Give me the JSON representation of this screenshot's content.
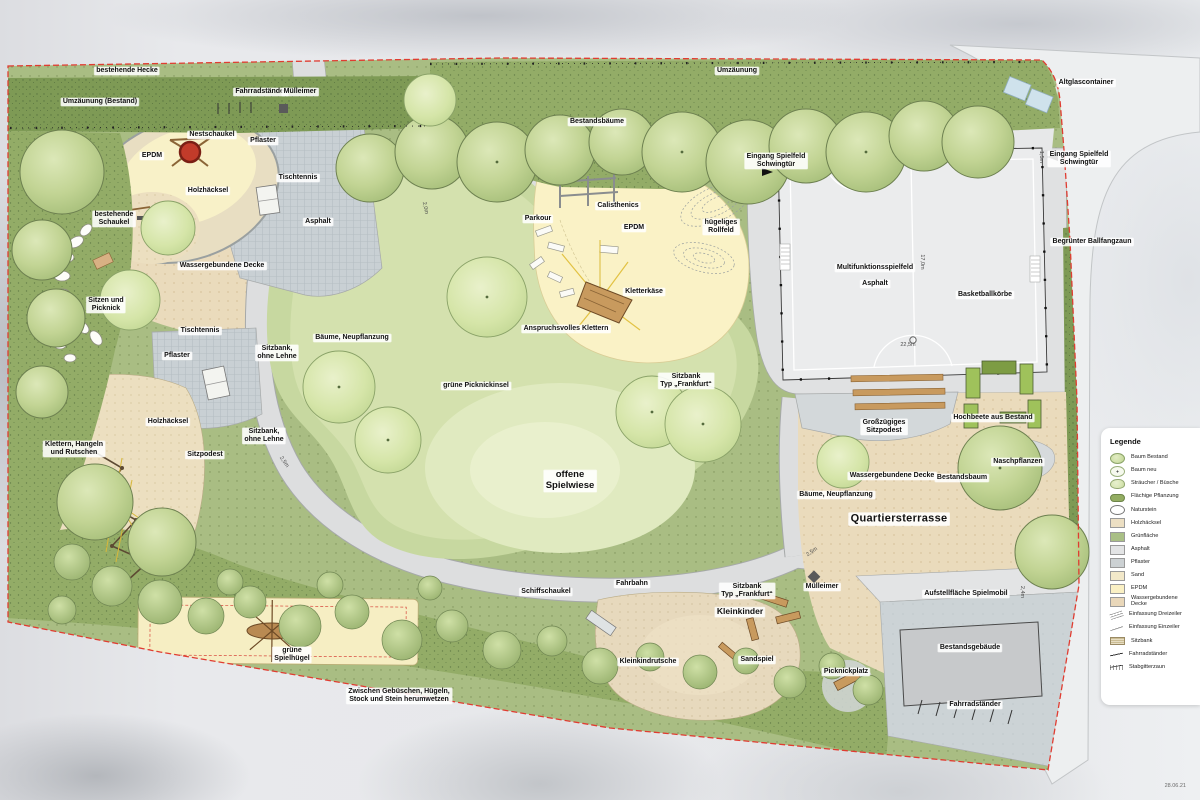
{
  "stamp": {
    "date": "28.06.21"
  },
  "legend": {
    "title": "Legende",
    "items": [
      {
        "label": "Baum Bestand",
        "icon": "tree-existing"
      },
      {
        "label": "Baum neu",
        "icon": "tree-new"
      },
      {
        "label": "Sträucher / Büsche",
        "icon": "shrub"
      },
      {
        "label": "Flächige Pflanzung",
        "icon": "planting"
      },
      {
        "label": "Naturstein",
        "icon": "stone"
      },
      {
        "label": "Holzhäcksel",
        "icon": "swatch",
        "color": "#ecdfc3"
      },
      {
        "label": "Grünfläche",
        "icon": "swatch",
        "color": "#a9bf85"
      },
      {
        "label": "Asphalt",
        "icon": "swatch",
        "color": "#e3e4e5"
      },
      {
        "label": "Pflaster",
        "icon": "swatch",
        "color": "#ccd1d3"
      },
      {
        "label": "Sand",
        "icon": "swatch",
        "color": "#f2e8c9"
      },
      {
        "label": "EPDM",
        "icon": "swatch",
        "color": "#faf0c4"
      },
      {
        "label": "Wassergebundene Decke",
        "icon": "swatch",
        "color": "#e9d7b9"
      },
      {
        "label": "Einfassung Dreizeiler",
        "icon": "edging-three"
      },
      {
        "label": "Einfassung Einzeiler",
        "icon": "edging-one"
      },
      {
        "label": "Sitzbank",
        "icon": "bench"
      },
      {
        "label": "Fahrradständer",
        "icon": "bike-rack"
      },
      {
        "label": "Stabgitterzaun",
        "icon": "fence"
      }
    ]
  },
  "map_labels": [
    {
      "name": "label-bestehende-hecke",
      "text": "bestehende Hecke",
      "x": 127,
      "y": 71
    },
    {
      "name": "label-umzaeunung-bestand",
      "text": "Umzäunung (Bestand)",
      "x": 100,
      "y": 102
    },
    {
      "name": "label-fahrradstaender-top",
      "text": "Fahrradständer",
      "x": 261,
      "y": 92
    },
    {
      "name": "label-muelleimer-top",
      "text": "Mülleimer",
      "x": 300,
      "y": 92
    },
    {
      "name": "label-bestandsbaeume",
      "text": "Bestandsbäume",
      "x": 597,
      "y": 122
    },
    {
      "name": "label-umzaeunung",
      "text": "Umzäunung",
      "x": 737,
      "y": 71
    },
    {
      "name": "label-altglascontainer",
      "text": "Altglascontainer",
      "x": 1086,
      "y": 83
    },
    {
      "name": "label-eingang-spielfeld-1",
      "text": "Eingang Spielfeld\nSchwingtür",
      "x": 776,
      "y": 161
    },
    {
      "name": "label-eingang-spielfeld-2",
      "text": "Eingang Spielfeld\nSchwingtür",
      "x": 1079,
      "y": 159
    },
    {
      "name": "label-nestschaukel",
      "text": "Nestschaukel",
      "x": 212,
      "y": 135
    },
    {
      "name": "label-pflaster-1",
      "text": "Pflaster",
      "x": 263,
      "y": 141
    },
    {
      "name": "label-epdm-1",
      "text": "EPDM",
      "x": 152,
      "y": 156
    },
    {
      "name": "label-tischtennis-1",
      "text": "Tischtennis",
      "x": 298,
      "y": 178
    },
    {
      "name": "label-holzhaecksel-1",
      "text": "Holzhäcksel",
      "x": 208,
      "y": 191
    },
    {
      "name": "label-bestehende-schaukel",
      "text": "bestehende\nSchaukel",
      "x": 114,
      "y": 219
    },
    {
      "name": "label-asphalt-weg",
      "text": "Asphalt",
      "x": 318,
      "y": 222
    },
    {
      "name": "label-wassergebundene-decke-1",
      "text": "Wassergebundene Decke",
      "x": 222,
      "y": 266
    },
    {
      "name": "label-parkour",
      "text": "Parkour",
      "x": 538,
      "y": 219
    },
    {
      "name": "label-calisthenics",
      "text": "Calisthenics",
      "x": 618,
      "y": 206
    },
    {
      "name": "label-epdm-2",
      "text": "EPDM",
      "x": 634,
      "y": 228
    },
    {
      "name": "label-huegeliges-rollfeld",
      "text": "hügeliges\nRollfeld",
      "x": 721,
      "y": 227
    },
    {
      "name": "label-multifunktionsspielfeld",
      "text": "Multifunktionsspielfeld",
      "x": 875,
      "y": 268
    },
    {
      "name": "label-asphalt-feld",
      "text": "Asphalt",
      "x": 875,
      "y": 284
    },
    {
      "name": "label-basketballkoerbe",
      "text": "Basketballkörbe",
      "x": 985,
      "y": 295
    },
    {
      "name": "label-begruenter-ballfangzaun",
      "text": "Begrünter Ballfangzaun",
      "x": 1092,
      "y": 242
    },
    {
      "name": "label-sitzen-und-picknick",
      "text": "Sitzen und\nPicknick",
      "x": 106,
      "y": 305
    },
    {
      "name": "label-tischtennis-2",
      "text": "Tischtennis",
      "x": 200,
      "y": 331
    },
    {
      "name": "label-pflaster-2",
      "text": "Pflaster",
      "x": 177,
      "y": 356
    },
    {
      "name": "label-baeume-neupflanzung-1",
      "text": "Bäume, Neupflanzung",
      "x": 352,
      "y": 338
    },
    {
      "name": "label-sitzbank-ohne-lehne-1",
      "text": "Sitzbank,\nohne Lehne",
      "x": 277,
      "y": 353
    },
    {
      "name": "label-kletterkaese",
      "text": "Kletterkäse",
      "x": 644,
      "y": 292
    },
    {
      "name": "label-anspruchsvolles-klettern",
      "text": "Anspruchsvolles Klettern",
      "x": 566,
      "y": 329
    },
    {
      "name": "label-sitzbank-frankfurt-1",
      "text": "Sitzbank\nTyp „Frankfurt“",
      "x": 686,
      "y": 381
    },
    {
      "name": "label-gruene-picknickinsel",
      "text": "grüne Picknickinsel",
      "x": 476,
      "y": 386
    },
    {
      "name": "label-holzhaecksel-2",
      "text": "Holzhäcksel",
      "x": 168,
      "y": 422
    },
    {
      "name": "label-sitzbank-ohne-lehne-2",
      "text": "Sitzbank,\nohne Lehne",
      "x": 264,
      "y": 436
    },
    {
      "name": "label-klettern-hangeln",
      "text": "Klettern, Hangeln\nund Rutschen",
      "x": 74,
      "y": 449
    },
    {
      "name": "label-sitzpodest",
      "text": "Sitzpodest",
      "x": 205,
      "y": 455
    },
    {
      "name": "label-grosszuegiges-sitzpodest",
      "text": "Großzügiges\nSitzpodest",
      "x": 884,
      "y": 427
    },
    {
      "name": "label-hochbeete-aus-bestand",
      "text": "Hochbeete aus Bestand",
      "x": 993,
      "y": 418
    },
    {
      "name": "label-naschpflanzen",
      "text": "Naschpflanzen",
      "x": 1018,
      "y": 462
    },
    {
      "name": "label-wassergebundene-decke-2",
      "text": "Wassergebundene Decke",
      "x": 892,
      "y": 476
    },
    {
      "name": "label-bestandsbaum",
      "text": "Bestandsbaum",
      "x": 962,
      "y": 478
    },
    {
      "name": "label-baeume-neupflanzung-2",
      "text": "Bäume, Neupflanzung",
      "x": 836,
      "y": 495
    },
    {
      "name": "label-offene-spielwiese",
      "text": "offene\nSpielwiese",
      "x": 570,
      "y": 481,
      "cls": "lg"
    },
    {
      "name": "label-quartiersterrasse",
      "text": "Quartiersterrasse",
      "x": 899,
      "y": 519,
      "cls": "xl"
    },
    {
      "name": "label-fahrbahn",
      "text": "Fahrbahn",
      "x": 632,
      "y": 584
    },
    {
      "name": "label-schiffschaukel",
      "text": "Schiffschaukel",
      "x": 546,
      "y": 592
    },
    {
      "name": "label-sitzbank-frankfurt-2",
      "text": "Sitzbank\nTyp „Frankfurt“",
      "x": 747,
      "y": 591
    },
    {
      "name": "label-muelleimer-2",
      "text": "Mülleimer",
      "x": 822,
      "y": 587
    },
    {
      "name": "label-kleinkinder",
      "text": "Kleinkinder",
      "x": 740,
      "y": 612,
      "cls": "md"
    },
    {
      "name": "label-aufstellflaeche-spielmobil",
      "text": "Aufstellfläche Spielmobil",
      "x": 966,
      "y": 594
    },
    {
      "name": "label-bestandsgebaeude",
      "text": "Bestandsgebäude",
      "x": 970,
      "y": 648
    },
    {
      "name": "label-gruene-spielhuegel",
      "text": "grüne\nSpielhügel",
      "x": 292,
      "y": 655
    },
    {
      "name": "label-kleinkindrutsche",
      "text": "Kleinkindrutsche",
      "x": 648,
      "y": 662
    },
    {
      "name": "label-sandspiel",
      "text": "Sandspiel",
      "x": 757,
      "y": 660
    },
    {
      "name": "label-picknickplatz",
      "text": "Picknickplatz",
      "x": 846,
      "y": 672
    },
    {
      "name": "label-zwischen-gebueschen",
      "text": "Zwischen Gebüschen, Hügeln,\nStock und Stein herumwetzen",
      "x": 399,
      "y": 696
    },
    {
      "name": "label-fahrradstaender-2",
      "text": "Fahrradständer",
      "x": 975,
      "y": 705
    }
  ],
  "dimensions": [
    {
      "name": "dim-weg-nord",
      "text": "2,0m",
      "x": 425,
      "y": 208,
      "rot": 78
    },
    {
      "name": "dim-weg-west",
      "text": "2,5m",
      "x": 284,
      "y": 462,
      "rot": 55
    },
    {
      "name": "dim-feld-breite",
      "text": "22,5m",
      "x": 908,
      "y": 345,
      "rot": 0
    },
    {
      "name": "dim-feld-hoehe",
      "text": "17,0m",
      "x": 922,
      "y": 262,
      "rot": 90
    },
    {
      "name": "dim-eingang",
      "text": "1,5m",
      "x": 1041,
      "y": 157,
      "rot": 90
    },
    {
      "name": "dim-weg-sued",
      "text": "2,5m",
      "x": 812,
      "y": 552,
      "rot": -35
    },
    {
      "name": "dim-spielmobil",
      "text": "2,4m",
      "x": 1022,
      "y": 592,
      "rot": 90
    }
  ]
}
